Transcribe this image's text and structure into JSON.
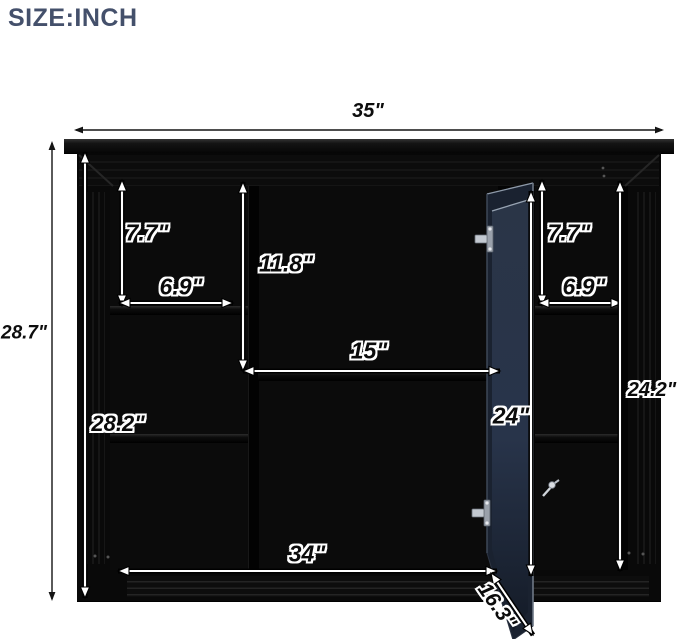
{
  "title": "SIZE:INCH",
  "colors": {
    "title": "#44506B",
    "cabinet_black": "#070707",
    "door_glass_top": "#2a3547",
    "door_glass_bottom": "#141b27",
    "dimension_dark": "#141414",
    "dimension_light": "#ffffff"
  },
  "dimensions": [
    {
      "id": "overall-width",
      "label": "35\"",
      "style": "dark",
      "x1": 74,
      "y1": 130,
      "x2": 664,
      "y2": 130,
      "lx": 368,
      "ly": 111,
      "fs": 20
    },
    {
      "id": "overall-height",
      "label": "28.7\"",
      "style": "dark",
      "x1": 52,
      "y1": 141,
      "x2": 52,
      "y2": 601,
      "lx": 24,
      "ly": 333,
      "fs": 19
    },
    {
      "id": "interior-height",
      "label": "28.2\"",
      "style": "light",
      "x1": 85,
      "y1": 152,
      "x2": 85,
      "y2": 598,
      "lx": 118,
      "ly": 424,
      "fs": 22
    },
    {
      "id": "left-top-shelf-height",
      "label": "7.7\"",
      "style": "light",
      "x1": 122,
      "y1": 180,
      "x2": 122,
      "y2": 306,
      "lx": 147,
      "ly": 233,
      "fs": 23
    },
    {
      "id": "left-shelf-width",
      "label": "6.9\"",
      "style": "light",
      "x1": 119,
      "y1": 303,
      "x2": 233,
      "y2": 303,
      "lx": 181,
      "ly": 287,
      "fs": 23
    },
    {
      "id": "middle-top-height",
      "label": "11.8\"",
      "style": "light",
      "x1": 243,
      "y1": 182,
      "x2": 243,
      "y2": 371,
      "lx": 286,
      "ly": 264,
      "fs": 23
    },
    {
      "id": "middle-width",
      "label": "15\"",
      "style": "light",
      "x1": 243,
      "y1": 371,
      "x2": 500,
      "y2": 371,
      "lx": 369,
      "ly": 351,
      "fs": 23
    },
    {
      "id": "door-height",
      "label": "24\"",
      "style": "light",
      "x1": 531,
      "y1": 191,
      "x2": 531,
      "y2": 576,
      "lx": 511,
      "ly": 416,
      "fs": 23
    },
    {
      "id": "right-top-shelf-height",
      "label": "7.7\"",
      "style": "light",
      "x1": 542,
      "y1": 180,
      "x2": 542,
      "y2": 306,
      "lx": 569,
      "ly": 233,
      "fs": 23
    },
    {
      "id": "right-shelf-width",
      "label": "6.9\"",
      "style": "light",
      "x1": 538,
      "y1": 303,
      "x2": 622,
      "y2": 303,
      "lx": 584,
      "ly": 287,
      "fs": 23
    },
    {
      "id": "right-side-height",
      "label": "24.2\"",
      "style": "light",
      "x1": 620,
      "y1": 181,
      "x2": 620,
      "y2": 571,
      "lx": 652,
      "ly": 390,
      "fs": 20
    },
    {
      "id": "bottom-width",
      "label": "34\"",
      "style": "light",
      "x1": 118,
      "y1": 571,
      "x2": 497,
      "y2": 571,
      "lx": 307,
      "ly": 554,
      "fs": 23
    },
    {
      "id": "door-depth",
      "label": "16.3\"",
      "style": "light",
      "x1": 491,
      "y1": 573,
      "x2": 533,
      "y2": 635,
      "lx": 497,
      "ly": 606,
      "fs": 21,
      "rot": 55
    }
  ]
}
